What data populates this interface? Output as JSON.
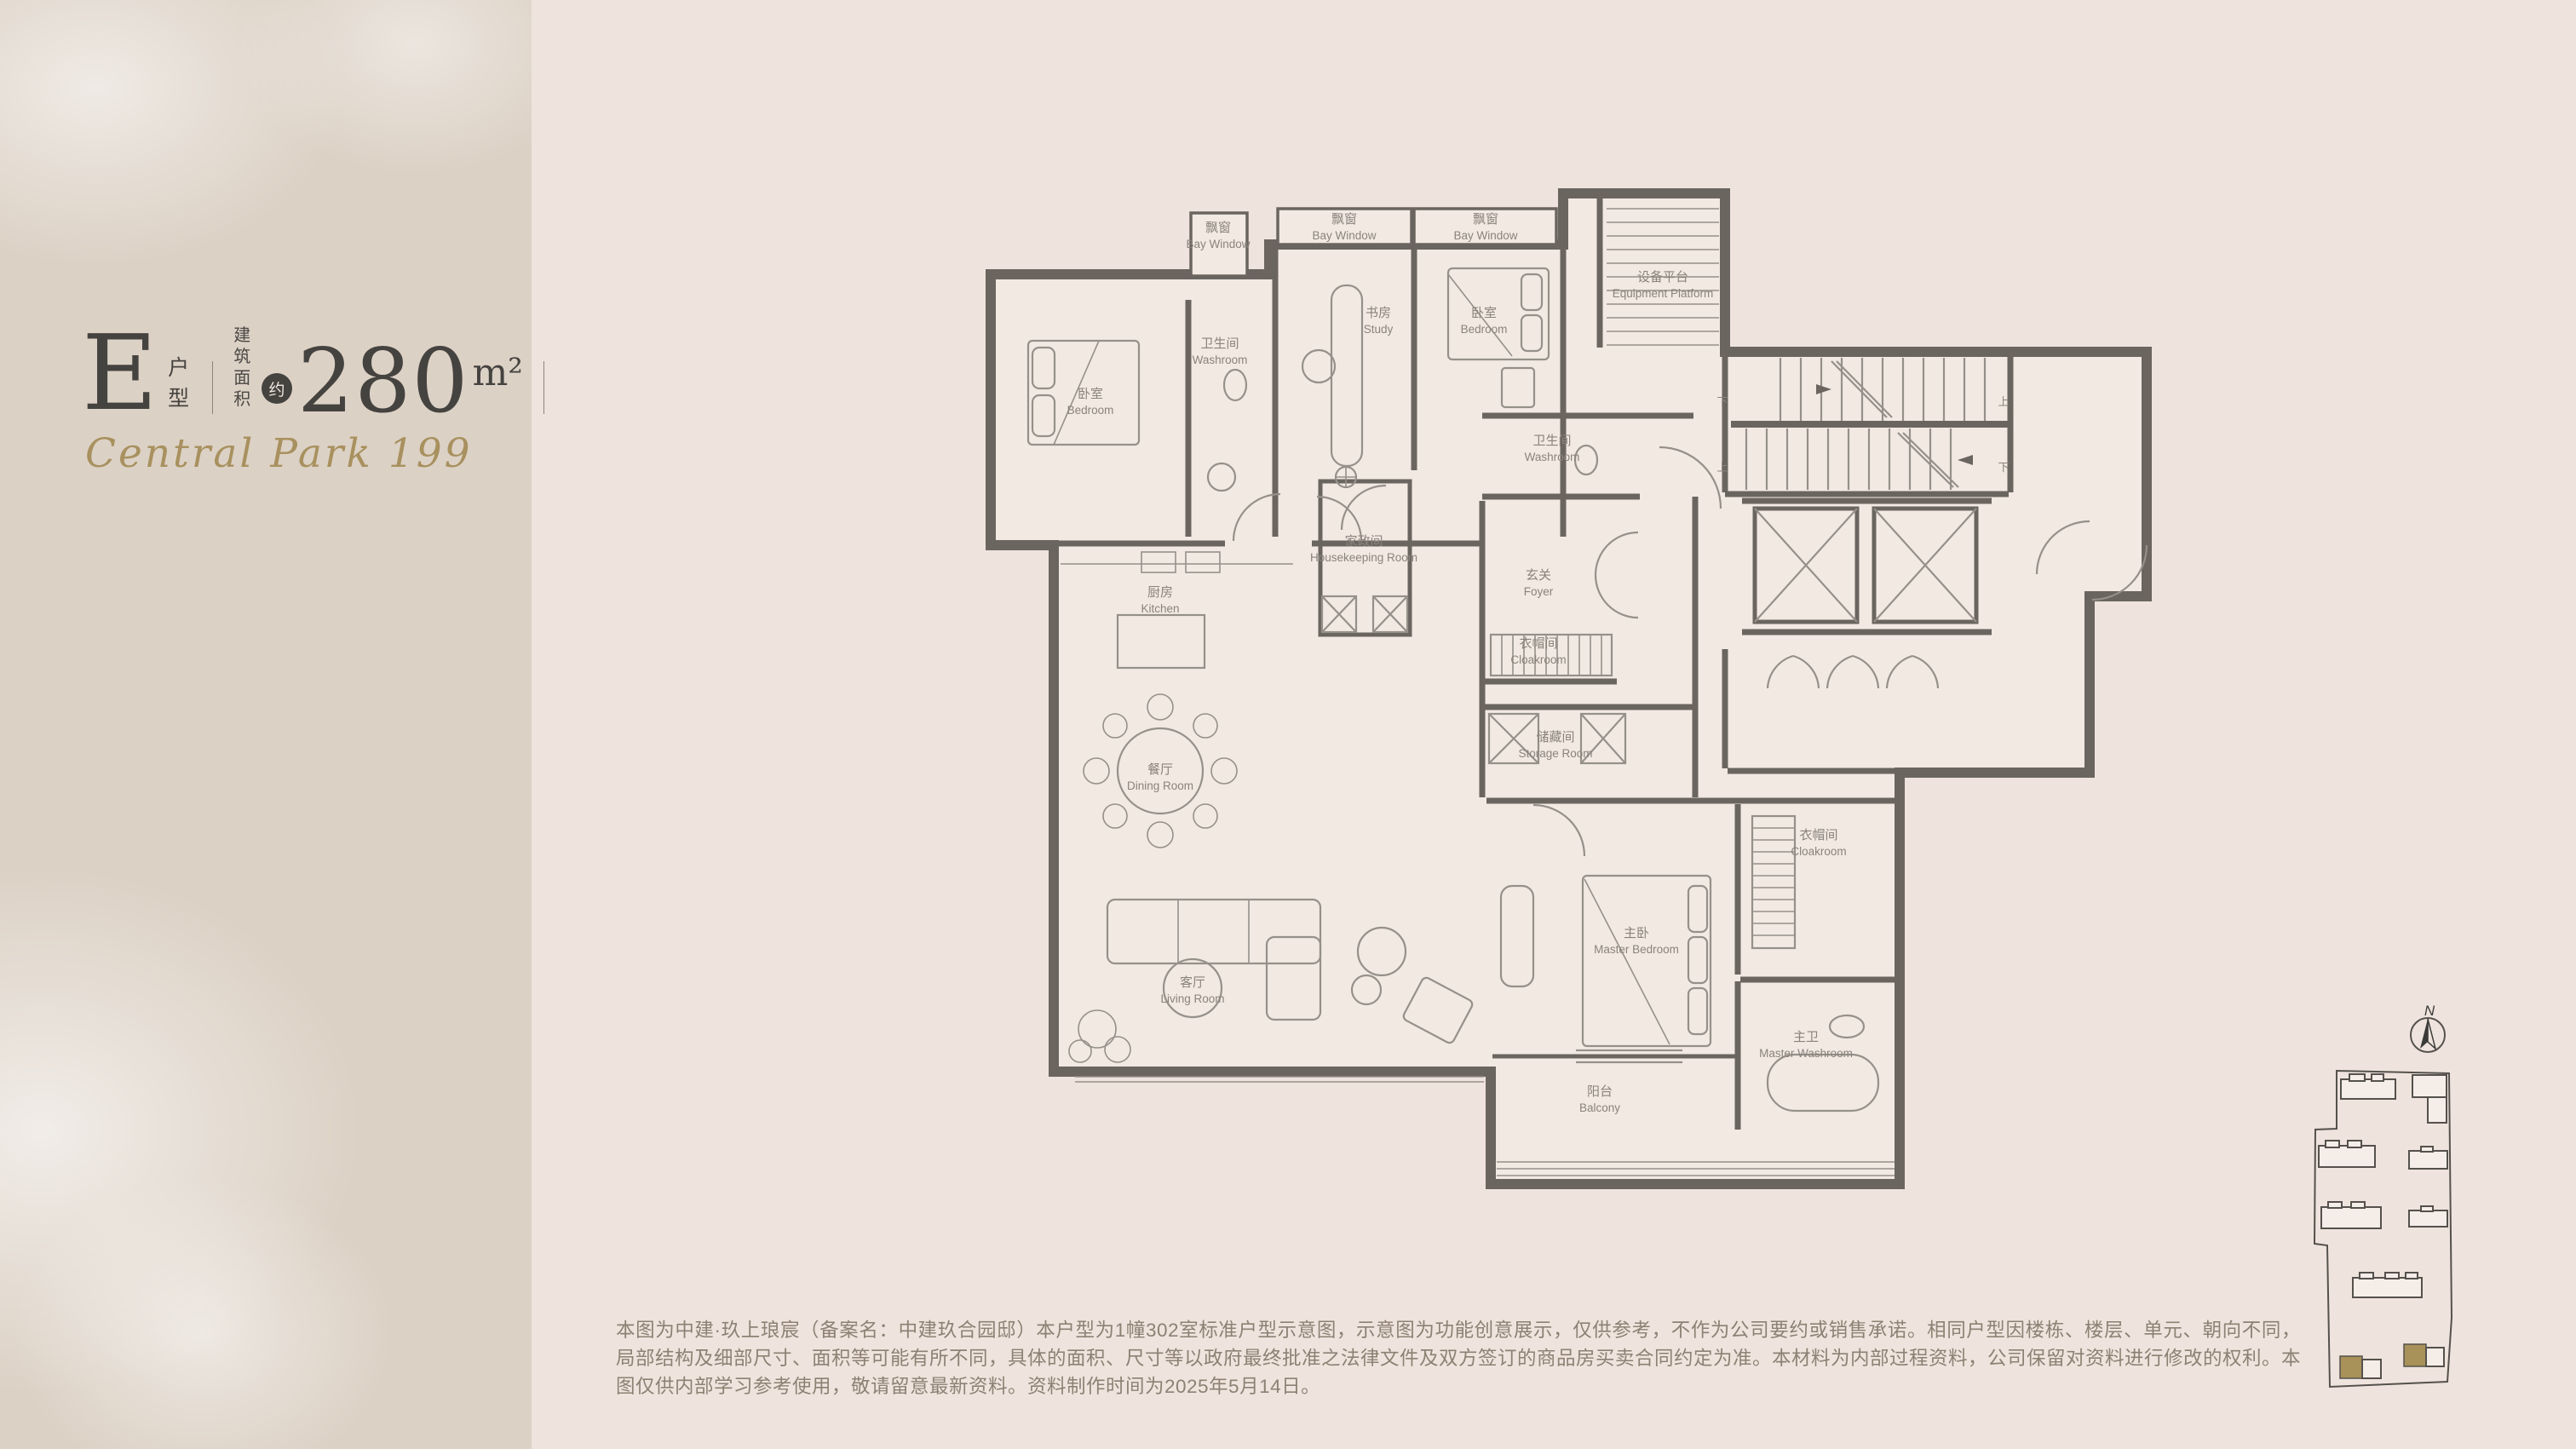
{
  "panel": {
    "unit_letter": "E",
    "unit_label": "户型",
    "area_label_line1": "建筑",
    "area_label_line2": "面积",
    "approx_label": "约",
    "area_value": "280",
    "area_unit": "m²",
    "project_name": "Central Park 199"
  },
  "floor_plan": {
    "rooms": [
      {
        "id": "bay-window-1",
        "zh": "飘窗",
        "en": "Bay Window"
      },
      {
        "id": "bay-window-2",
        "zh": "飘窗",
        "en": "Bay Window"
      },
      {
        "id": "bay-window-3",
        "zh": "飘窗",
        "en": "Bay Window"
      },
      {
        "id": "bedroom-1",
        "zh": "卧室",
        "en": "Bedroom"
      },
      {
        "id": "washroom-1",
        "zh": "卫生间",
        "en": "Washroom"
      },
      {
        "id": "study",
        "zh": "书房",
        "en": "Study"
      },
      {
        "id": "bedroom-2",
        "zh": "卧室",
        "en": "Bedroom"
      },
      {
        "id": "equipment-platform",
        "zh": "设备平台",
        "en": "Equipment Platform"
      },
      {
        "id": "washroom-2",
        "zh": "卫生间",
        "en": "Washroom"
      },
      {
        "id": "housekeeping-room",
        "zh": "家政间",
        "en": "Housekeeping Room"
      },
      {
        "id": "foyer",
        "zh": "玄关",
        "en": "Foyer"
      },
      {
        "id": "cloakroom-1",
        "zh": "衣帽间",
        "en": "Cloakroom"
      },
      {
        "id": "kitchen",
        "zh": "厨房",
        "en": "Kitchen"
      },
      {
        "id": "storage-room",
        "zh": "储藏间",
        "en": "Storage Room"
      },
      {
        "id": "dining-room",
        "zh": "餐厅",
        "en": "Dining Room"
      },
      {
        "id": "living-room",
        "zh": "客厅",
        "en": "Living Room"
      },
      {
        "id": "master-bedroom",
        "zh": "主卧",
        "en": "Master Bedroom"
      },
      {
        "id": "cloakroom-2",
        "zh": "衣帽间",
        "en": "Cloakroom"
      },
      {
        "id": "master-washroom",
        "zh": "主卫",
        "en": "Master Washroom"
      },
      {
        "id": "balcony",
        "zh": "阳台",
        "en": "Balcony"
      }
    ],
    "stairs": {
      "up": "上",
      "down": "下"
    }
  },
  "site_map": {
    "north_label": "N",
    "highlight_color": "#a8925a"
  },
  "disclaimer": {
    "text": "本图为中建·玖上琅宸（备案名：中建玖合园邸）本户型为1幢302室标准户型示意图，示意图为功能创意展示，仅供参考，不作为公司要约或销售承诺。相同户型因楼栋、楼层、单元、朝向不同，局部结构及细部尺寸、面积等可能有所不同，具体的面积、尺寸等以政府最终批准之法律文件及双方签订的商品房买卖合同约定为准。本材料为内部过程资料，公司保留对资料进行修改的权利。本图仅供内部学习参考使用，敬请留意最新资料。资料制作时间为2025年5月14日。"
  },
  "colors": {
    "accent_gold": "#a8915f",
    "wall": "#6b6560",
    "background": "#efe4dd",
    "sidebar": "#dcd1c5"
  }
}
